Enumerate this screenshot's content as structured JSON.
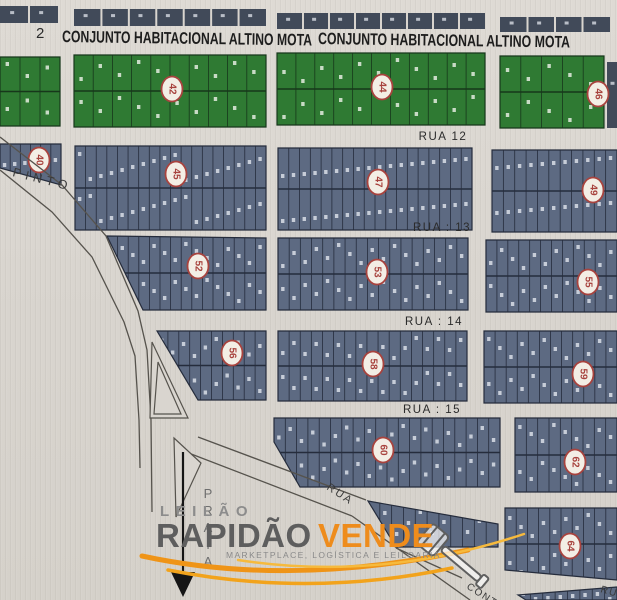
{
  "header": {
    "left_number": "2",
    "titles": [
      "CONJUNTO HABITACIONAL ALTINO MOTA",
      "CONJUNTO HABITACIONAL ALTINO MOTA"
    ]
  },
  "streets": {
    "rua12": "RUA  12",
    "rua13": "RUA : 13",
    "rua14": "RUA : 14",
    "rua15": "RUA :  15",
    "pinto": "PINTO",
    "rua_diagonal": "RUA",
    "cont": "CONT.",
    "rua_corner": "RUA"
  },
  "map": {
    "colors": {
      "paper": "#d9d5cf",
      "green_block": "#2f7a33",
      "green_line": "#17371b",
      "blue_block": "#5d6a82",
      "blue_line": "#252c3c",
      "strip_block": "#414a59",
      "road_line": "#56534d",
      "badge_fill": "#f3eee5",
      "badge_stroke": "#a8433e",
      "badge_text": "#a8433e",
      "arrow": "#151515"
    },
    "top_strips": [
      [
        0,
        6,
        58,
        17,
        2
      ],
      [
        74,
        9,
        192,
        17,
        7
      ],
      [
        277,
        13,
        208,
        16,
        8
      ],
      [
        500,
        17,
        110,
        15,
        4
      ],
      [
        607,
        62,
        10,
        66,
        1
      ]
    ],
    "blocks": [
      {
        "id": "1",
        "type": "green",
        "rect": [
          0,
          57,
          60,
          69
        ],
        "cols": 3,
        "rows": 2
      },
      {
        "id": "2",
        "type": "green",
        "rect": [
          74,
          55,
          192,
          72
        ],
        "cols": 10,
        "rows": 2,
        "badge": [
          172,
          89,
          "42"
        ]
      },
      {
        "id": "3",
        "type": "green",
        "rect": [
          277,
          53,
          208,
          72
        ],
        "cols": 11,
        "rows": 2,
        "badge": [
          382,
          87,
          "44"
        ]
      },
      {
        "id": "4",
        "type": "green",
        "rect": [
          500,
          56,
          104,
          72
        ],
        "cols": 5,
        "rows": 2,
        "badge": [
          598,
          94,
          "46"
        ]
      },
      {
        "id": "5",
        "type": "blue",
        "points": [
          [
            0,
            144
          ],
          [
            61,
            144
          ],
          [
            61,
            185
          ],
          [
            0,
            168
          ]
        ],
        "cols": 6,
        "rows": 1,
        "badge": [
          39,
          160,
          "40"
        ]
      },
      {
        "id": "6",
        "type": "blue",
        "rect": [
          75,
          146,
          191,
          84
        ],
        "cols": 18,
        "rows": 2,
        "badge": [
          176,
          174,
          "45"
        ]
      },
      {
        "id": "7",
        "type": "blue",
        "rect": [
          278,
          148,
          194,
          82
        ],
        "cols": 18,
        "rows": 2,
        "badge": [
          378,
          182,
          "47"
        ]
      },
      {
        "id": "8",
        "type": "blue",
        "rect": [
          492,
          150,
          125,
          82
        ],
        "cols": 11,
        "rows": 2,
        "badge": [
          593,
          190,
          "49"
        ]
      },
      {
        "id": "9",
        "type": "blue",
        "points": [
          [
            107,
            236
          ],
          [
            266,
            238
          ],
          [
            266,
            310
          ],
          [
            143,
            310
          ]
        ],
        "cols": 15,
        "rows": 2,
        "badge": [
          198,
          266,
          "52"
        ]
      },
      {
        "id": "10",
        "type": "blue",
        "rect": [
          278,
          238,
          190,
          72
        ],
        "cols": 17,
        "rows": 2,
        "badge": [
          377,
          272,
          "53"
        ]
      },
      {
        "id": "11",
        "type": "blue",
        "rect": [
          486,
          240,
          131,
          72
        ],
        "cols": 12,
        "rows": 2,
        "badge": [
          588,
          282,
          "55"
        ]
      },
      {
        "id": "12",
        "type": "blue",
        "points": [
          [
            157,
            331
          ],
          [
            266,
            331
          ],
          [
            266,
            400
          ],
          [
            198,
            400
          ]
        ],
        "cols": 10,
        "rows": 2,
        "badge": [
          232,
          353,
          "56"
        ]
      },
      {
        "id": "13",
        "type": "blue",
        "rect": [
          278,
          331,
          189,
          70
        ],
        "cols": 17,
        "rows": 2,
        "badge": [
          373,
          364,
          "58"
        ]
      },
      {
        "id": "14",
        "type": "blue",
        "rect": [
          484,
          331,
          133,
          72
        ],
        "cols": 12,
        "rows": 2,
        "badge": [
          583,
          374,
          "59"
        ]
      },
      {
        "id": "15",
        "type": "blue",
        "points": [
          [
            274,
            418
          ],
          [
            500,
            418
          ],
          [
            500,
            487
          ],
          [
            300,
            487
          ],
          [
            274,
            442
          ]
        ],
        "cols": 20,
        "rows": 2,
        "badge": [
          383,
          450,
          "60"
        ]
      },
      {
        "id": "16",
        "type": "blue",
        "rect": [
          515,
          418,
          102,
          74
        ],
        "cols": 9,
        "rows": 2,
        "badge": [
          575,
          462,
          "62"
        ]
      },
      {
        "id": "17",
        "type": "blue",
        "points": [
          [
            368,
            501
          ],
          [
            498,
            524
          ],
          [
            498,
            547
          ],
          [
            396,
            547
          ]
        ],
        "cols": 11,
        "rows": 1
      },
      {
        "id": "18",
        "type": "blue",
        "points": [
          [
            505,
            508
          ],
          [
            617,
            508
          ],
          [
            617,
            580
          ],
          [
            505,
            570
          ]
        ],
        "cols": 10,
        "rows": 2,
        "badge": [
          570,
          546,
          "64"
        ]
      },
      {
        "id": "19",
        "type": "blue",
        "points": [
          [
            518,
            595
          ],
          [
            617,
            587
          ],
          [
            617,
            600
          ],
          [
            526,
            600
          ]
        ],
        "cols": 8,
        "rows": 1
      }
    ],
    "roads": [
      [
        [
          0,
          137
        ],
        [
          62,
          185
        ],
        [
          106,
          236
        ],
        [
          138,
          311
        ],
        [
          147,
          350
        ],
        [
          151,
          420
        ],
        [
          152,
          512
        ]
      ],
      [
        [
          0,
          170
        ],
        [
          52,
          212
        ],
        [
          92,
          257
        ],
        [
          124,
          322
        ],
        [
          135,
          356
        ],
        [
          139,
          420
        ],
        [
          140,
          468
        ]
      ],
      [
        [
          198,
          437
        ],
        [
          366,
          500
        ]
      ],
      [
        [
          186,
          452
        ],
        [
          352,
          516
        ]
      ],
      [
        [
          352,
          516
        ],
        [
          470,
          600
        ]
      ],
      [
        [
          396,
          548
        ],
        [
          462,
          578
        ]
      ]
    ],
    "wedges": [
      [
        [
          152,
          342
        ],
        [
          188,
          418
        ],
        [
          150,
          418
        ]
      ],
      [
        [
          158,
          362
        ],
        [
          181,
          414
        ],
        [
          154,
          414
        ]
      ],
      [
        [
          174,
          438
        ],
        [
          201,
          463
        ],
        [
          176,
          517
        ]
      ]
    ],
    "arrow": {
      "line": [
        183,
        452,
        183,
        574
      ],
      "head": [
        [
          171,
          572
        ],
        [
          195,
          572
        ],
        [
          183,
          597
        ]
      ]
    },
    "vertical_label": {
      "text": "PRAIA",
      "x": 208,
      "y": 498,
      "step": 17
    }
  },
  "watermark": {
    "line1": "LEILÃO",
    "brand_dark": "RAPIDÃO",
    "brand_accent": "VENDE",
    "subtitle": "MARKETPLACE, LOGÍSTICA E LEILOARIA",
    "colors": {
      "line1": "#8c8c8c",
      "brand_dark": "#5e5e5e",
      "brand_accent": "#ee8c1c",
      "subtitle": "#8a8a8a",
      "swoosh": "#f0971c",
      "swoosh_light": "#f6ba3d"
    }
  }
}
